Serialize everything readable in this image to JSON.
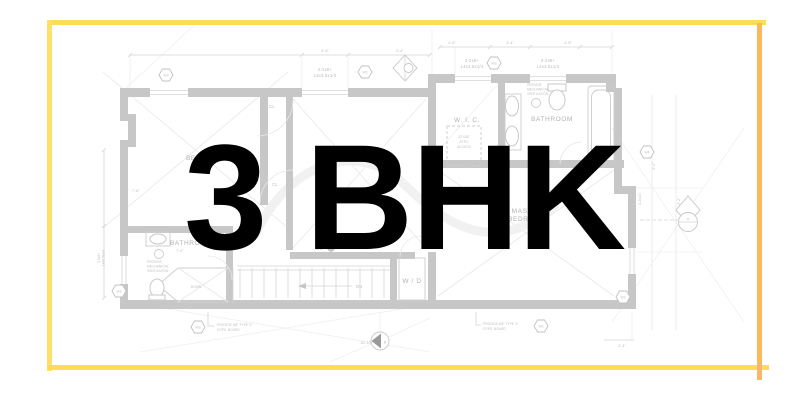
{
  "title": {
    "text": "3 BHK"
  },
  "frame": {
    "border_color": "#FFDC55",
    "border_left_color": "#FFE06A",
    "border_right_color": "#FBB95C"
  },
  "plan": {
    "rooms": {
      "bedroom": "BEDROOM",
      "wic": "W. I. C.",
      "bathroom_top": "BATHROOM",
      "master_line1": "MASTER",
      "master_line2": "BEDROOM",
      "bathroom_bottom": "BATHROOM",
      "washer_dryer": "W / D",
      "closet": "CL",
      "landing": "DOWN",
      "down": "DN"
    },
    "annotations": {
      "header_line1": "2-2x8+",
      "header_line2": "L4x3.5x1/4",
      "attic_line1": "22\"x28\"",
      "attic_line2": "ATTIC",
      "attic_line3": "ACCESS",
      "vent_line1": "PROVIDE",
      "vent_line2": "MECHANICAL",
      "vent_line3": "VENTILATION",
      "gyps_line1": "PROVIDE 5/8\" TYPE 'X'",
      "gyps_line2": "GYPS. BOARD",
      "joist": "2-2x10",
      "co": "CO"
    },
    "markers": {
      "w3": "W3",
      "w4": "W4",
      "a": "A",
      "b": "B"
    },
    "dims": {
      "d1": "4'-6\"",
      "d2": "2'-4\"",
      "d3": "3'-4\"",
      "d4": "7'-6\"",
      "d5": "7'-4\"",
      "d6": "16'-10\"",
      "d7": "4'-4\"",
      "d8": "2'-2\""
    }
  }
}
